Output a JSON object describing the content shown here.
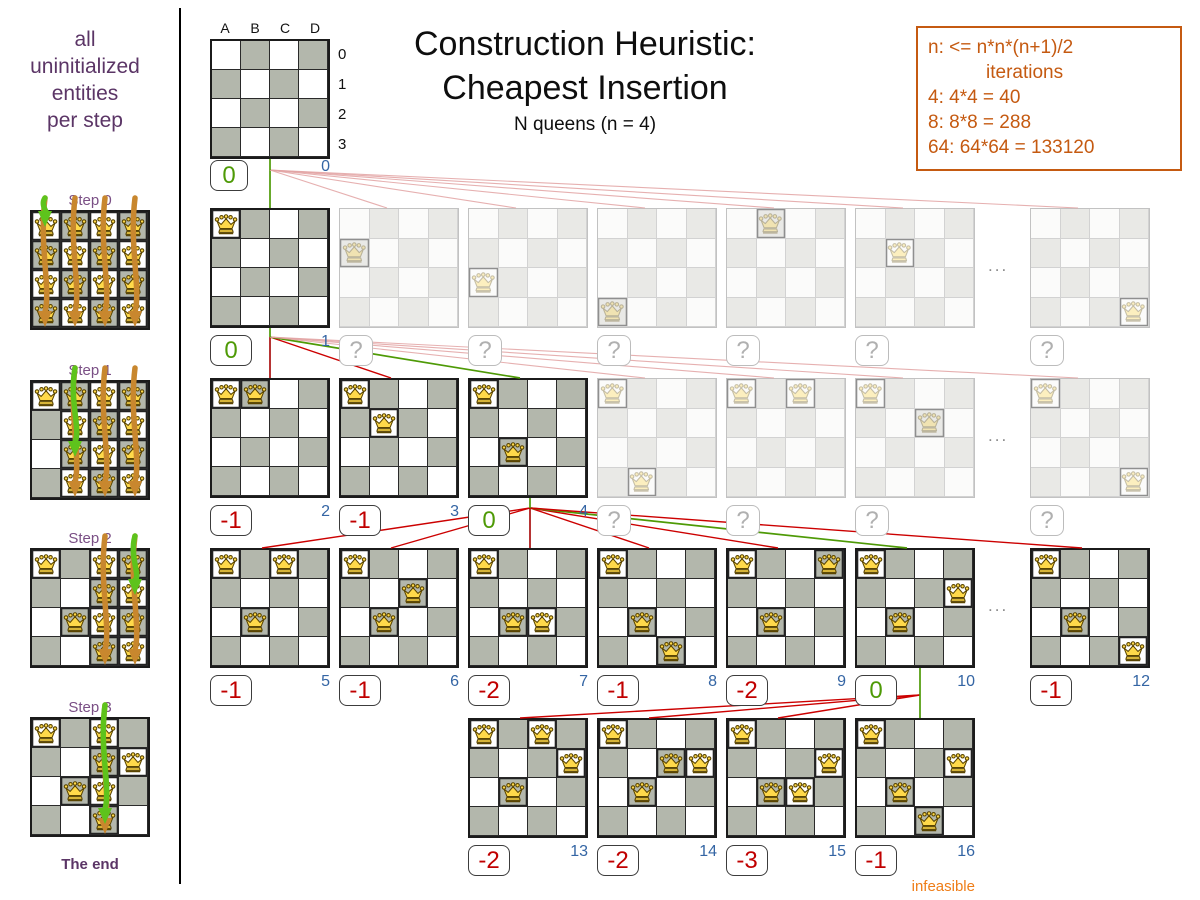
{
  "header": {
    "title_line1": "Construction Heuristic:",
    "title_line2": "Cheapest Insertion",
    "subtitle": "N queens (n = 4)"
  },
  "note_box": {
    "lines": [
      "n: <= n*n*(n+1)/2",
      "iterations",
      "4: 4*4 = 40",
      "8: 8*8 = 288",
      "64: 64*64 = 133120"
    ]
  },
  "sidebar": {
    "note_lines": [
      "all",
      "uninitialized",
      "entities",
      "per step"
    ],
    "end_label": "The end",
    "steps": [
      {
        "label": "Step 0",
        "fixed": [],
        "candidate_cols": [
          0,
          1,
          2,
          3
        ],
        "chosen": "A0"
      },
      {
        "label": "Step 1",
        "fixed": [
          "A0"
        ],
        "candidate_cols": [
          1,
          2,
          3
        ],
        "chosen": "B2"
      },
      {
        "label": "Step 2",
        "fixed": [
          "A0",
          "B2"
        ],
        "candidate_cols": [
          2,
          3
        ],
        "chosen": "D1"
      },
      {
        "label": "Step 3",
        "fixed": [
          "A0",
          "B2",
          "D1"
        ],
        "candidate_cols": [
          2
        ],
        "chosen": "C3"
      }
    ]
  },
  "root_board": {
    "col_labels": [
      "A",
      "B",
      "C",
      "D"
    ],
    "row_labels": [
      "0",
      "1",
      "2",
      "3"
    ],
    "score": "0",
    "iteration": "0"
  },
  "infeasible_label": "infeasible",
  "ellipsis": "...",
  "tree_rows": [
    {
      "boards": [
        {
          "queens": [
            "A0"
          ],
          "score": "0",
          "iteration": "1",
          "state": "active",
          "link": "green"
        },
        {
          "queens": [
            "A1"
          ],
          "score": "?",
          "state": "faded",
          "link": "pink"
        },
        {
          "queens": [
            "A2"
          ],
          "score": "?",
          "state": "faded",
          "link": "pink"
        },
        {
          "queens": [
            "A3"
          ],
          "score": "?",
          "state": "faded",
          "link": "pink"
        },
        {
          "queens": [
            "B0"
          ],
          "score": "?",
          "state": "faded",
          "link": "pink"
        },
        {
          "queens": [
            "B1"
          ],
          "score": "?",
          "state": "faded",
          "link": "pink"
        },
        {
          "dots": true
        },
        {
          "queens": [
            "D3"
          ],
          "score": "?",
          "state": "faded",
          "link": "pink"
        }
      ]
    },
    {
      "boards": [
        {
          "queens": [
            "A0",
            "B0"
          ],
          "score": "-1",
          "iteration": "2",
          "state": "active",
          "link": "red"
        },
        {
          "queens": [
            "A0",
            "B1"
          ],
          "score": "-1",
          "iteration": "3",
          "state": "active",
          "link": "red"
        },
        {
          "queens": [
            "A0",
            "B2"
          ],
          "score": "0",
          "iteration": "4",
          "state": "active",
          "link": "green"
        },
        {
          "queens": [
            "A0",
            "B3"
          ],
          "score": "?",
          "state": "faded",
          "link": "pink"
        },
        {
          "queens": [
            "A0",
            "C0"
          ],
          "score": "?",
          "state": "faded",
          "link": "pink"
        },
        {
          "queens": [
            "A0",
            "C1"
          ],
          "score": "?",
          "state": "faded",
          "link": "pink"
        },
        {
          "dots": true
        },
        {
          "queens": [
            "A0",
            "D3"
          ],
          "score": "?",
          "state": "faded",
          "link": "pink"
        }
      ]
    },
    {
      "boards": [
        {
          "queens": [
            "A0",
            "B2",
            "C0"
          ],
          "score": "-1",
          "iteration": "5",
          "state": "active",
          "link": "red"
        },
        {
          "queens": [
            "A0",
            "B2",
            "C1"
          ],
          "score": "-1",
          "iteration": "6",
          "state": "active",
          "link": "red"
        },
        {
          "queens": [
            "A0",
            "B2",
            "C2"
          ],
          "score": "-2",
          "iteration": "7",
          "state": "active",
          "link": "red"
        },
        {
          "queens": [
            "A0",
            "B2",
            "C3"
          ],
          "score": "-1",
          "iteration": "8",
          "state": "active",
          "link": "red"
        },
        {
          "queens": [
            "A0",
            "B2",
            "D0"
          ],
          "score": "-2",
          "iteration": "9",
          "state": "active",
          "link": "red"
        },
        {
          "queens": [
            "A0",
            "B2",
            "D1"
          ],
          "score": "0",
          "iteration": "10",
          "state": "active",
          "link": "green"
        },
        {
          "dots": true
        },
        {
          "queens": [
            "A0",
            "B2",
            "D3"
          ],
          "score": "-1",
          "iteration": "12",
          "state": "active",
          "link": "red"
        }
      ]
    },
    {
      "start_slot": 2,
      "boards": [
        {
          "queens": [
            "A0",
            "C0",
            "D1",
            "B2"
          ],
          "score": "-2",
          "iteration": "13",
          "state": "active",
          "link": "red"
        },
        {
          "queens": [
            "A0",
            "C1",
            "D1",
            "B2"
          ],
          "score": "-2",
          "iteration": "14",
          "state": "active",
          "link": "red"
        },
        {
          "queens": [
            "A0",
            "D1",
            "B2",
            "C2"
          ],
          "score": "-3",
          "iteration": "15",
          "state": "active",
          "link": "red"
        },
        {
          "queens": [
            "A0",
            "D1",
            "B2",
            "C3"
          ],
          "score": "-1",
          "iteration": "16",
          "state": "active",
          "link": "green",
          "note": "infeasible"
        }
      ]
    }
  ],
  "colors": {
    "green": "#4e9a06",
    "red": "#c00000",
    "blue": "#3465a4",
    "orange": "#c55a11",
    "infeasible_orange": "#ef7d17",
    "purple_dark": "#5b3566",
    "purple_light": "#7a4f85",
    "pink_line": "#e2a3a3",
    "board_dark_cell": "#b3b7ac",
    "faded_cell": "#e9e9e6",
    "queen_gold": "#ffd94a",
    "arrow_orange": "#c8872e",
    "arrow_green": "#5ec31c"
  }
}
